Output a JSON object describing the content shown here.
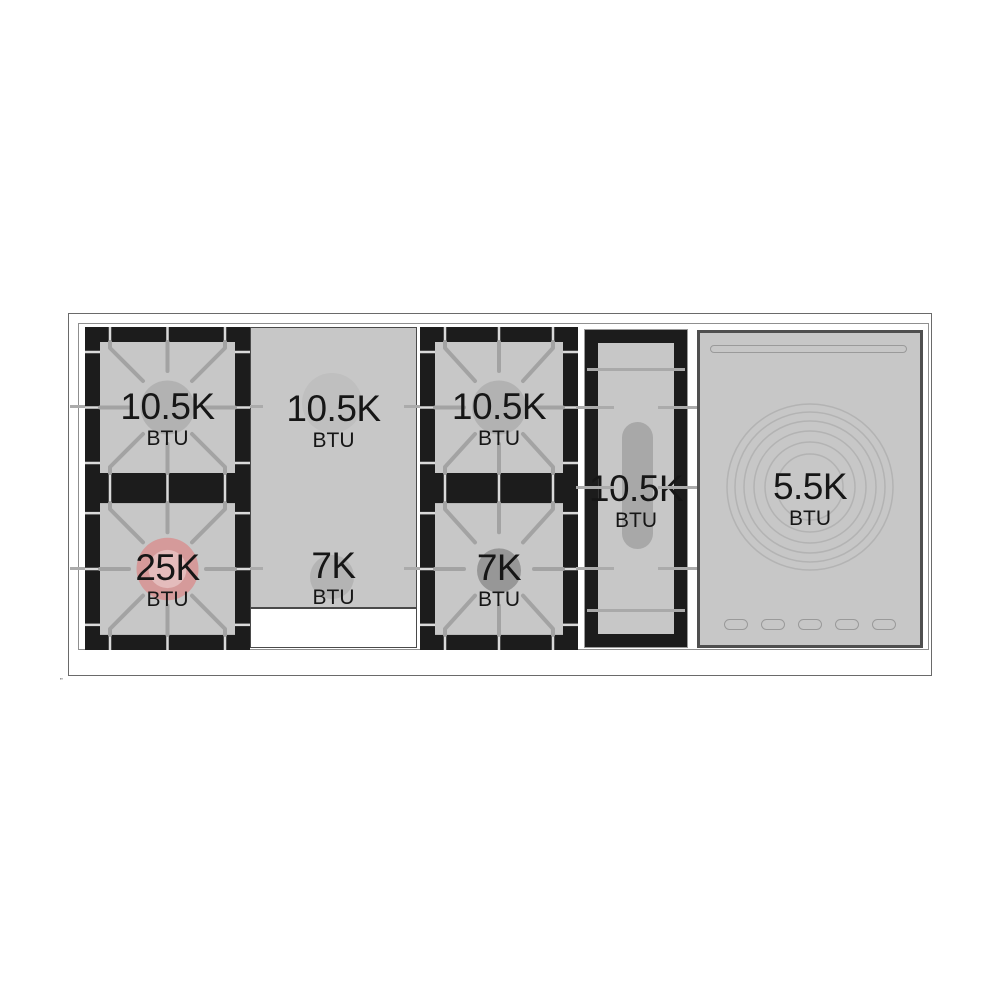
{
  "burners": {
    "top_left": {
      "value": "10.5K",
      "unit": "BTU"
    },
    "bottom_left": {
      "value": "25K",
      "unit": "BTU"
    },
    "griddle_top": {
      "value": "10.5K",
      "unit": "BTU"
    },
    "griddle_bottom": {
      "value": "7K",
      "unit": "BTU"
    },
    "top_middle": {
      "value": "10.5K",
      "unit": "BTU"
    },
    "bottom_middle": {
      "value": "7K",
      "unit": "BTU"
    },
    "oval": {
      "value": "10.5K",
      "unit": "BTU"
    },
    "warming_zone": {
      "value": "5.5K",
      "unit": "BTU"
    }
  },
  "colors": {
    "surface_gray": "#c7c7c7",
    "frame_black": "#1c1c1c",
    "grate_line": "#a3a3a3",
    "standard_burner_circle": "#b2b2b2",
    "small_burner_circle": "#979797",
    "high_output_burner_circle": "#d59a9a",
    "ring_line": "#b3b3b3"
  },
  "artifact_mark": "”"
}
